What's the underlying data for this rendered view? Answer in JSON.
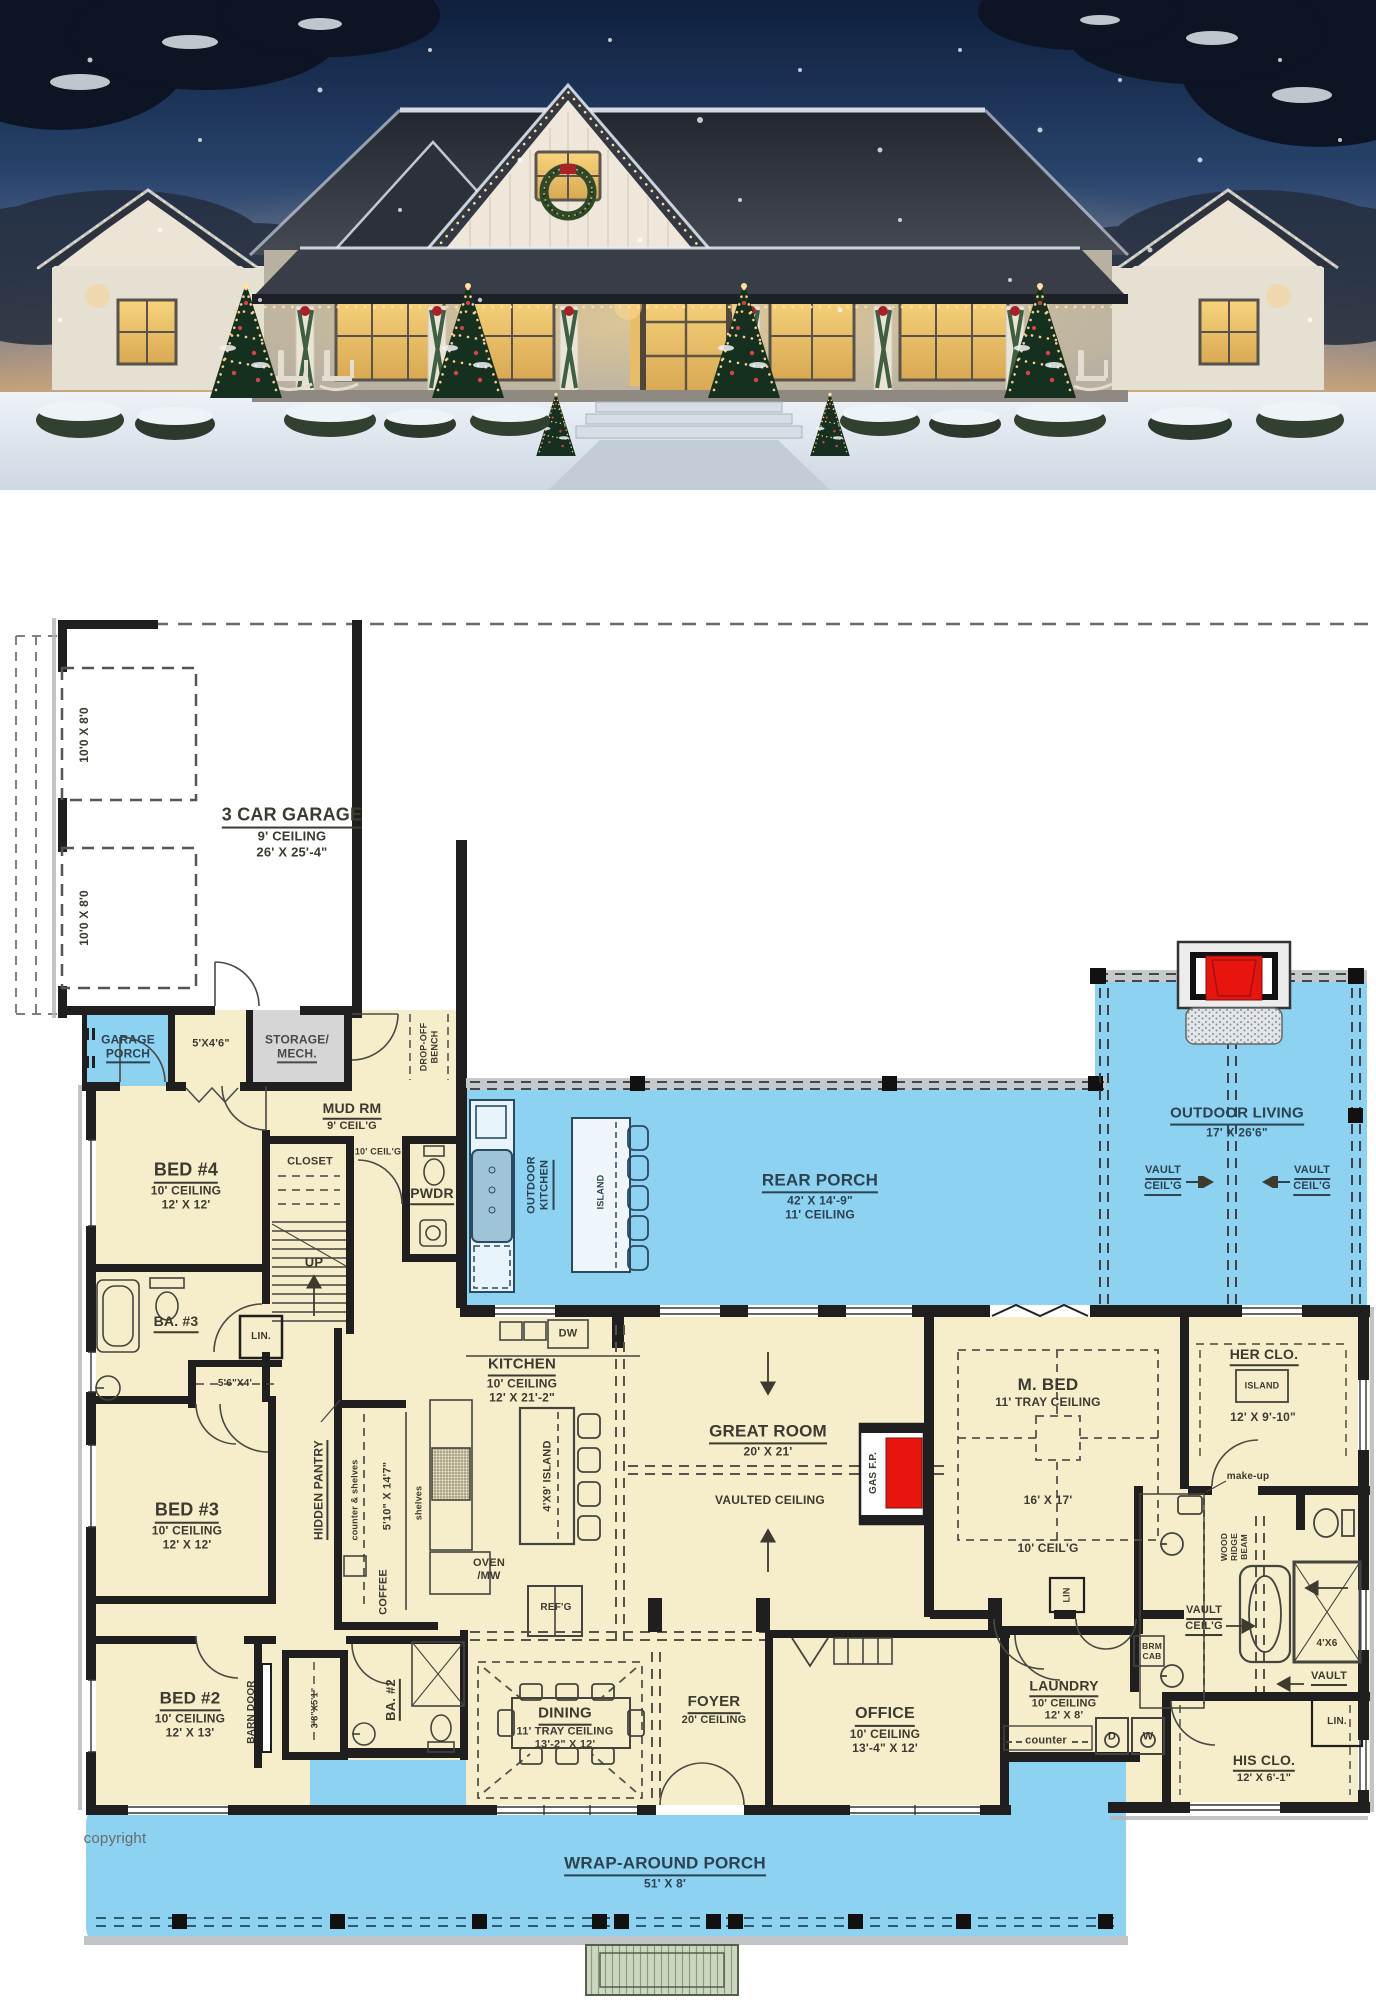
{
  "colors": {
    "porch_fill": "#8ed2f2",
    "room_fill": "#f6eeca",
    "storage_fill": "#d6d6d6",
    "fireplace_red": "#e8150f",
    "wall": "#1f1f1f",
    "label_ink": "#3d3a30",
    "porch_ink": "#2b4250"
  },
  "plan": {
    "garage": {
      "title": "3 CAR GARAGE",
      "ceiling": "9' CEILING",
      "size": "26' X 25'-4\"",
      "door_size": "10'0 X 8'0"
    },
    "garage_porch": {
      "l1": "GARAGE",
      "l2": "PORCH"
    },
    "closet_5x46": "5'X4'6\"",
    "storage": {
      "l1": "STORAGE/",
      "l2": "MECH."
    },
    "drop_off": {
      "l1": "DROP-OFF",
      "l2": "BENCH"
    },
    "mud": {
      "title": "MUD RM",
      "ceiling": "9' CEIL'G"
    },
    "closet": "CLOSET",
    "ceil10": "10' CEIL'G",
    "pwdr": "PWDR",
    "up": "UP",
    "bed4": {
      "title": "BED #4",
      "ceiling": "10' CEILING",
      "size": "12' X 12'"
    },
    "ba3": "BA. #3",
    "lin_dot": "LIN.",
    "closet_56x4": "5'6\"X4'",
    "bed3": {
      "title": "BED #3",
      "ceiling": "10' CEILING",
      "size": "12' X 12'"
    },
    "hidden_pantry": "HIDDEN PANTRY",
    "counter_shelves": "counter & shelves",
    "pantry_size": "5'10\" X 14'7\"",
    "shelves": "shelves",
    "coffee": "COFFEE",
    "kitchen": {
      "title": "KITCHEN",
      "ceiling": "10' CEILING",
      "size": "12' X 21'-2\""
    },
    "dw": "DW",
    "island_4x9": "4'X9' ISLAND",
    "oven": {
      "l1": "OVEN",
      "l2": "/MW"
    },
    "refg": "REF'G",
    "outdoor_kitchen": {
      "l1": "OUTDOOR",
      "l2": "KITCHEN"
    },
    "island": "ISLAND",
    "rear_porch": {
      "title": "REAR PORCH",
      "size": "42' X 14'-9\"",
      "ceiling": "11' CEILING"
    },
    "outdoor_living": {
      "title": "OUTDOOR LIVING",
      "size": "17' X 26'6\""
    },
    "vault": {
      "l1": "VAULT",
      "l2": "CEIL'G"
    },
    "vault_single": "VAULT",
    "great": {
      "title": "GREAT ROOM",
      "size": "20' X 21'",
      "note": "VAULTED CEILING"
    },
    "gas_fp": "GAS F.P.",
    "mbed": {
      "title": "M. BED",
      "tray": "11' TRAY CEILING",
      "size": "16' X 17'",
      "ceiling": "10' CEIL'G"
    },
    "her_clo": {
      "title": "HER CLO.",
      "island": "ISLAND",
      "size": "12' X 9'-10\""
    },
    "makeup": "make-up",
    "ridge_beam": {
      "l1": "WOOD",
      "l2": "RIDGE",
      "l3": "BEAM"
    },
    "shower_4x6": "4'X6",
    "his_clo": {
      "title": "HIS CLO.",
      "size": "12' X 6'-1\""
    },
    "brm_cab": {
      "l1": "BRM",
      "l2": "CAB"
    },
    "laundry": {
      "title": "LAUNDRY",
      "ceiling": "10' CEILING",
      "size": "12' X 8'"
    },
    "counter": "counter",
    "dryer": "D",
    "washer": "W",
    "lin": "LIN",
    "office": {
      "title": "OFFICE",
      "ceiling": "10' CEILING",
      "size": "13'-4\" X 12'"
    },
    "foyer": {
      "title": "FOYER",
      "ceiling": "20' CEILING"
    },
    "dining": {
      "title": "DINING",
      "tray": "11' TRAY CEILING",
      "size": "13'-2\" X 12'"
    },
    "ba2": "BA. #2",
    "bed2": {
      "title": "BED #2",
      "ceiling": "10' CEILING",
      "size": "12' X 13'"
    },
    "barn_door": "BARN DOOR",
    "ba2_closet": "3'8\"X5'1\"",
    "wrap_porch": {
      "title": "WRAP-AROUND PORCH",
      "size": "51' X 8'"
    },
    "copyright": "copyright"
  }
}
